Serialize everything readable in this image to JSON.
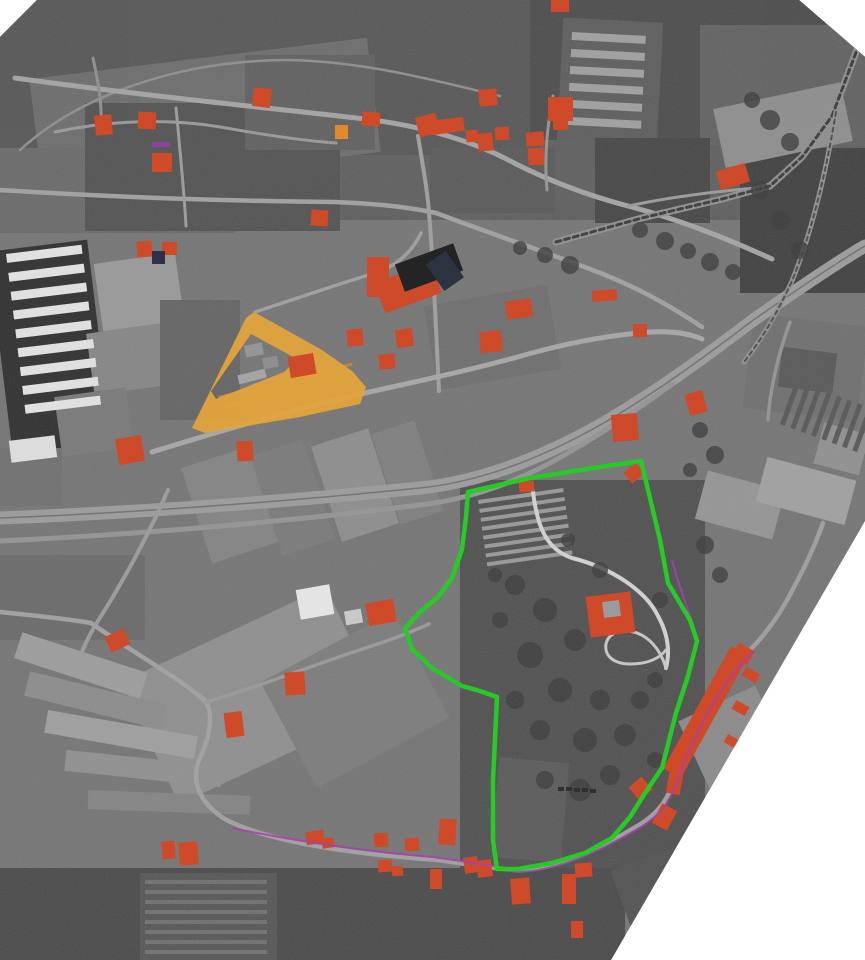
{
  "image": {
    "width": 865,
    "height": 960,
    "paper": "#ffffff"
  },
  "colors": {
    "photo_base": "#747474",
    "red_building": "#cf4a28",
    "dark_building": "#262626",
    "navy_building": "#2c3148",
    "purple_building": "#8a41a8",
    "orange_building": "#e08a28",
    "white_building": "#e4e4e4",
    "gray_building": "#969696",
    "yellow_complex": "#e2a43c",
    "yellow_ridge": "#bc852f",
    "green_boundary": "#26cb26",
    "magenta_line": "#a641ad",
    "tree": "#3a3a3a",
    "car": "#303030"
  },
  "photo_outline": [
    [
      0,
      37
    ],
    [
      37,
      0
    ],
    [
      799,
      0
    ],
    [
      865,
      57
    ],
    [
      865,
      521
    ],
    [
      611,
      960
    ],
    [
      0,
      960
    ]
  ],
  "terrain_patches": [
    [
      0,
      0,
      865,
      220,
      0,
      "#5e5e5e"
    ],
    [
      0,
      0,
      540,
      155,
      0,
      "#565656"
    ],
    [
      530,
      0,
      340,
      140,
      0,
      "#4b4b4b"
    ],
    [
      700,
      25,
      165,
      120,
      0,
      "#616161"
    ],
    [
      35,
      58,
      340,
      115,
      -7,
      "#6c6c6c"
    ],
    [
      0,
      148,
      235,
      85,
      0,
      "#696969"
    ],
    [
      85,
      103,
      255,
      128,
      0,
      "#515151"
    ],
    [
      245,
      55,
      130,
      95,
      0,
      "#5f5f5f"
    ],
    [
      560,
      20,
      100,
      125,
      3,
      "#5c5c5c"
    ],
    [
      430,
      148,
      125,
      65,
      0,
      "#585858"
    ],
    [
      595,
      138,
      115,
      85,
      0,
      "#454545"
    ],
    [
      740,
      148,
      130,
      145,
      0,
      "#3f3f3f"
    ],
    [
      718,
      95,
      130,
      60,
      -12,
      "#8d8d8d"
    ],
    [
      0,
      245,
      100,
      205,
      -7,
      "#2e2e2e"
    ],
    [
      98,
      258,
      82,
      68,
      -8,
      "#989898"
    ],
    [
      90,
      328,
      78,
      62,
      -8,
      "#858585"
    ],
    [
      58,
      392,
      72,
      60,
      -8,
      "#787878"
    ],
    [
      0,
      448,
      62,
      58,
      0,
      "#6f6f6f"
    ],
    [
      160,
      300,
      80,
      120,
      0,
      "#636363"
    ],
    [
      195,
      455,
      70,
      100,
      -18,
      "#828282"
    ],
    [
      265,
      445,
      55,
      105,
      -18,
      "#797979"
    ],
    [
      325,
      435,
      60,
      100,
      -18,
      "#8c8c8c"
    ],
    [
      385,
      425,
      45,
      95,
      -18,
      "#7e7e7e"
    ],
    [
      430,
      295,
      125,
      85,
      -10,
      "#6d6d6d"
    ],
    [
      460,
      480,
      245,
      400,
      0,
      "#4f4f4f"
    ],
    [
      495,
      760,
      70,
      100,
      5,
      "#595959"
    ],
    [
      690,
      700,
      85,
      75,
      -25,
      "#8a8a8a"
    ],
    [
      700,
      480,
      80,
      50,
      15,
      "#949494"
    ],
    [
      760,
      468,
      92,
      46,
      15,
      "#a0a0a0"
    ],
    [
      818,
      428,
      47,
      42,
      15,
      "#8f8f8f"
    ],
    [
      748,
      320,
      115,
      95,
      7,
      "#6e6e6e"
    ],
    [
      780,
      350,
      55,
      40,
      7,
      "#575757"
    ],
    [
      0,
      555,
      145,
      85,
      0,
      "#696969"
    ],
    [
      140,
      628,
      225,
      135,
      -25,
      "#8e8e8e"
    ],
    [
      280,
      640,
      150,
      120,
      -28,
      "#7b7b7b"
    ],
    [
      15,
      652,
      132,
      27,
      18,
      "#9c9c9c"
    ],
    [
      25,
      688,
      142,
      25,
      14,
      "#8b8b8b"
    ],
    [
      45,
      723,
      152,
      23,
      10,
      "#9e9e9e"
    ],
    [
      65,
      758,
      157,
      21,
      6,
      "#8f8f8f"
    ],
    [
      88,
      793,
      162,
      19,
      2,
      "#838383"
    ],
    [
      0,
      868,
      625,
      92,
      0,
      "#494949"
    ],
    [
      140,
      873,
      137,
      87,
      0,
      "#555555"
    ],
    [
      620,
      855,
      80,
      70,
      -20,
      "#525252"
    ]
  ],
  "stripe_blocks": [
    {
      "x": 6,
      "y": 254,
      "rows": 9,
      "pitch": 19,
      "len": 76,
      "h": 9,
      "rot": -7,
      "color": "#e3e3e3"
    },
    {
      "x": 572,
      "y": 32,
      "rows": 6,
      "pitch": 17,
      "len": 74,
      "h": 8,
      "rot": 3,
      "color": "#9f9f9f"
    },
    {
      "x": 780,
      "y": 424,
      "rows": 8,
      "pitch": 11,
      "len": 46,
      "h": 5,
      "rot": -70,
      "color": "#565656"
    },
    {
      "x": 478,
      "y": 500,
      "rows": 8,
      "pitch": 9,
      "len": 86,
      "h": 4,
      "rot": -8,
      "color": "#979797"
    },
    {
      "x": 145,
      "y": 880,
      "rows": 8,
      "pitch": 10,
      "len": 122,
      "h": 4,
      "rot": 0,
      "color": "#6f6f6f"
    },
    {
      "x": 218,
      "y": 396,
      "rows": 2,
      "pitch": 10,
      "len": 138,
      "h": 3,
      "rot": -14,
      "color": "#bc852f"
    }
  ],
  "roads": [
    {
      "d": "M20,150 C80,95 180,60 290,60 C370,62 440,82 500,96",
      "w": 2.5,
      "c": "#8d8d8d"
    },
    {
      "d": "M15,78 C130,94 260,107 365,119 C425,126 478,143 516,164 C552,182 590,196 628,206 C678,219 726,238 772,259",
      "w": 5,
      "c": "#a3a3a3"
    },
    {
      "d": "M628,206 C680,195 730,190 768,187",
      "w": 3,
      "c": "#9a9a9a"
    },
    {
      "d": "M0,190 C110,197 230,201 335,202 C385,204 412,208 436,213 C484,231 542,251 590,269 C640,288 672,307 702,327",
      "w": 4.5,
      "c": "#a0a0a0"
    },
    {
      "d": "M176,108 C180,150 184,190 186,226",
      "w": 3,
      "c": "#9a9a9a"
    },
    {
      "d": "M418,136 C424,172 428,196 429,213 C433,256 436,330 439,391",
      "w": 4,
      "c": "#9e9e9e"
    },
    {
      "d": "M255,312 C292,300 332,286 372,274 C396,267 412,252 421,233",
      "w": 3.5,
      "c": "#9e9e9e"
    },
    {
      "d": "M152,452 C230,428 312,404 392,387 C442,376 482,367 532,353 C572,342 612,335 650,332 C672,331 688,333 702,339",
      "w": 5,
      "c": "#a6a6a6"
    },
    {
      "d": "M0,518 C150,512 300,500 420,488 C480,482 542,458 602,424 C652,395 702,359 752,321 C802,286 836,263 865,246",
      "w": 13,
      "c": "#9b9b9b"
    },
    {
      "d": "M0,518 C150,512 300,500 420,488 C480,482 542,458 602,424 C652,395 702,359 752,321 C802,286 836,263 865,246",
      "w": 1.5,
      "c": "#6f6f6f"
    },
    {
      "d": "M0,541 C150,534 300,520 420,505 C472,499 522,480 566,454 C602,433 640,408 672,384",
      "w": 5,
      "c": "#939393"
    },
    {
      "d": "M556,242 L642,218 L722,199 L770,186 L802,157 L832,116 L858,47",
      "w": 7,
      "c": "#8f8f8f"
    },
    {
      "d": "M556,242 L642,218 L722,199 L770,186 L802,157 L832,116 L858,47",
      "w": 3,
      "c": "#3a3a3a",
      "dash": "5,4"
    },
    {
      "d": "M836,112 C826,172 812,232 792,281 C774,320 758,344 744,362",
      "w": 5,
      "c": "#8f8f8f"
    },
    {
      "d": "M836,112 C826,172 812,232 792,281 C774,320 758,344 744,362",
      "w": 2,
      "c": "#4a4a4a",
      "dash": "4,4"
    },
    {
      "d": "M168,490 C150,532 122,584 96,624 C90,634 85,644 81,654",
      "w": 4,
      "c": "#9a9a9a"
    },
    {
      "d": "M0,612 C30,615 62,618 91,623",
      "w": 4.5,
      "c": "#a0a0a0"
    },
    {
      "d": "M91,623 C132,652 186,682 206,702 C214,716 209,740 199,760 C191,782 199,801 223,818 C259,838 320,848 372,854 C406,858 426,859 438,860",
      "w": 4.5,
      "c": "#a0a0a0"
    },
    {
      "d": "M438,860 C473,865 501,870 523,870 C561,868 601,848 639,825 C659,813 667,799 673,784 C689,734 719,681 749,651 C766,634 781,613 793,589 C807,563 816,543 823,523",
      "w": 4.5,
      "c": "#9e9e9e"
    },
    {
      "d": "M206,702 C256,688 321,662 366,648 C396,638 416,630 429,624",
      "w": 3.5,
      "c": "#989898"
    },
    {
      "d": "M533,492 C537,524 545,549 572,558 C612,568 646,591 658,616 C668,634 670,652 666,668",
      "w": 4,
      "c": "#d2d2d2"
    },
    {
      "d": "M666,668 C660,648 648,636 634,632 C620,628 608,634 606,644 C604,656 614,664 630,664 C646,664 658,660 666,650",
      "w": 3,
      "c": "#c8c8c8"
    },
    {
      "d": "M768,420 C770,390 778,355 790,322",
      "w": 3.5,
      "c": "#929292"
    },
    {
      "d": "M55,132 C112,120 172,118 226,128 C271,136 306,141 336,143",
      "w": 3,
      "c": "#989898"
    },
    {
      "d": "M93,58 C100,90 103,112 100,133",
      "w": 3,
      "c": "#8f8f8f"
    },
    {
      "d": "M553,96 C547,128 544,158 547,190",
      "w": 3,
      "c": "#949494"
    }
  ],
  "trees": [
    [
      515,
      585,
      10
    ],
    [
      545,
      610,
      12
    ],
    [
      575,
      640,
      11
    ],
    [
      530,
      655,
      13
    ],
    [
      560,
      690,
      12
    ],
    [
      600,
      700,
      10
    ],
    [
      625,
      735,
      11
    ],
    [
      585,
      740,
      12
    ],
    [
      540,
      730,
      10
    ],
    [
      515,
      700,
      9
    ],
    [
      610,
      775,
      10
    ],
    [
      580,
      790,
      11
    ],
    [
      545,
      780,
      9
    ],
    [
      640,
      700,
      9
    ],
    [
      655,
      680,
      8
    ],
    [
      500,
      620,
      8
    ],
    [
      495,
      575,
      7
    ],
    [
      655,
      760,
      8
    ],
    [
      640,
      230,
      8
    ],
    [
      665,
      241,
      9
    ],
    [
      688,
      251,
      8
    ],
    [
      710,
      262,
      9
    ],
    [
      733,
      272,
      8
    ],
    [
      700,
      430,
      8
    ],
    [
      715,
      455,
      9
    ],
    [
      690,
      470,
      7
    ],
    [
      770,
      120,
      10
    ],
    [
      790,
      142,
      9
    ],
    [
      752,
      100,
      8
    ],
    [
      705,
      545,
      9
    ],
    [
      720,
      575,
      8
    ],
    [
      600,
      570,
      8
    ],
    [
      568,
      540,
      7
    ],
    [
      660,
      600,
      8
    ],
    [
      760,
      190,
      9
    ],
    [
      780,
      220,
      10
    ],
    [
      800,
      250,
      9
    ],
    [
      545,
      255,
      8
    ],
    [
      570,
      265,
      9
    ],
    [
      520,
      248,
      7
    ]
  ],
  "buildings": {
    "red": [
      [
        95,
        115,
        17,
        20,
        -5
      ],
      [
        138,
        112,
        18,
        17,
        3
      ],
      [
        152,
        153,
        20,
        19,
        0
      ],
      [
        253,
        88,
        18,
        19,
        7
      ],
      [
        362,
        112,
        18,
        14,
        3
      ],
      [
        417,
        115,
        21,
        20,
        -15
      ],
      [
        479,
        89,
        18,
        17,
        -5
      ],
      [
        548,
        97,
        25,
        24,
        0
      ],
      [
        551,
        0,
        18,
        12,
        0
      ],
      [
        553,
        117,
        15,
        13,
        0
      ],
      [
        430,
        119,
        34,
        14,
        -8
      ],
      [
        466,
        130,
        12,
        12,
        -5
      ],
      [
        478,
        133,
        15,
        18,
        -5
      ],
      [
        495,
        127,
        14,
        13,
        -3
      ],
      [
        526,
        132,
        18,
        14,
        -5
      ],
      [
        528,
        148,
        16,
        17,
        -3
      ],
      [
        718,
        167,
        30,
        19,
        -17
      ],
      [
        311,
        210,
        17,
        16,
        4
      ],
      [
        137,
        241,
        15,
        16,
        -5
      ],
      [
        162,
        242,
        15,
        13,
        0
      ],
      [
        367,
        257,
        22,
        40,
        0
      ],
      [
        378,
        272,
        60,
        32,
        -20
      ],
      [
        592,
        290,
        25,
        11,
        -4
      ],
      [
        506,
        300,
        26,
        18,
        -8
      ],
      [
        480,
        331,
        22,
        21,
        -5
      ],
      [
        633,
        324,
        14,
        13,
        0
      ],
      [
        347,
        329,
        16,
        17,
        -5
      ],
      [
        396,
        329,
        17,
        18,
        -8
      ],
      [
        379,
        354,
        16,
        15,
        -5
      ],
      [
        289,
        355,
        26,
        21,
        -10
      ],
      [
        117,
        437,
        26,
        26,
        -10
      ],
      [
        237,
        441,
        16,
        20,
        -4
      ],
      [
        687,
        392,
        18,
        22,
        -15
      ],
      [
        612,
        414,
        26,
        27,
        -5
      ],
      [
        519,
        481,
        15,
        11,
        -5
      ],
      [
        626,
        466,
        16,
        14,
        -40
      ],
      [
        588,
        594,
        45,
        41,
        -7
      ],
      [
        367,
        601,
        28,
        23,
        -10
      ],
      [
        107,
        632,
        21,
        17,
        -25
      ],
      [
        285,
        672,
        20,
        23,
        -4
      ],
      [
        225,
        712,
        18,
        25,
        -7
      ],
      [
        696,
        642,
        20,
        140,
        29
      ],
      [
        734,
        646,
        18,
        16,
        29
      ],
      [
        743,
        670,
        16,
        10,
        29
      ],
      [
        733,
        703,
        15,
        10,
        29
      ],
      [
        725,
        737,
        14,
        9,
        29
      ],
      [
        668,
        768,
        14,
        26,
        10
      ],
      [
        632,
        780,
        17,
        17,
        -40
      ],
      [
        656,
        806,
        17,
        22,
        28
      ],
      [
        439,
        819,
        17,
        26,
        4
      ],
      [
        464,
        857,
        14,
        16,
        -8
      ],
      [
        477,
        860,
        15,
        17,
        -8
      ],
      [
        511,
        878,
        19,
        26,
        -4
      ],
      [
        562,
        874,
        14,
        30,
        0
      ],
      [
        575,
        863,
        17,
        14,
        -4
      ],
      [
        571,
        921,
        12,
        17,
        0
      ],
      [
        430,
        869,
        12,
        20,
        0
      ],
      [
        162,
        841,
        13,
        18,
        -4
      ],
      [
        179,
        842,
        19,
        23,
        -4
      ],
      [
        306,
        831,
        18,
        13,
        -8
      ],
      [
        322,
        838,
        12,
        10,
        -8
      ],
      [
        374,
        833,
        14,
        14,
        -4
      ],
      [
        405,
        838,
        14,
        13,
        -4
      ],
      [
        378,
        860,
        14,
        12,
        -4
      ],
      [
        392,
        866,
        11,
        10,
        -4
      ]
    ],
    "dark": [
      [
        398,
        253,
        62,
        29,
        -20,
        "#242424"
      ],
      [
        433,
        255,
        24,
        32,
        -35,
        "#2b3440"
      ],
      [
        152,
        251,
        13,
        13,
        0,
        "#2c3148"
      ]
    ],
    "purple": [
      [
        152,
        142,
        18,
        5,
        0,
        "#8a41a8"
      ]
    ],
    "orange": [
      [
        335,
        125,
        13,
        14,
        0,
        "#e08a28"
      ]
    ],
    "white": [
      [
        298,
        587,
        34,
        30,
        -10,
        "#e4e4e4"
      ],
      [
        345,
        610,
        17,
        14,
        -10,
        "#c9c9c9"
      ],
      [
        10,
        438,
        46,
        22,
        -7,
        "#dcdcdc"
      ]
    ],
    "gray": [
      [
        603,
        601,
        17,
        16,
        -7,
        "#9b9b9b"
      ],
      [
        245,
        344,
        18,
        12,
        -10,
        "#969696"
      ],
      [
        263,
        357,
        15,
        11,
        -10,
        "#8f8f8f"
      ],
      [
        238,
        372,
        28,
        9,
        -14,
        "#a5a5a5"
      ]
    ]
  },
  "cars": [
    [
      558,
      787,
      6,
      4
    ],
    [
      566,
      787,
      6,
      4
    ],
    [
      574,
      788,
      6,
      4
    ],
    [
      582,
      788,
      6,
      4
    ],
    [
      590,
      789,
      6,
      4
    ]
  ],
  "yellow_complex": {
    "outer": [
      [
        254,
        312
      ],
      [
        322,
        350
      ],
      [
        352,
        371
      ],
      [
        366,
        387
      ],
      [
        360,
        404
      ],
      [
        300,
        417
      ],
      [
        205,
        433
      ],
      [
        192,
        428
      ],
      [
        246,
        318
      ]
    ],
    "hole": [
      [
        251,
        334
      ],
      [
        297,
        359
      ],
      [
        284,
        372
      ],
      [
        216,
        399
      ],
      [
        211,
        391
      ]
    ]
  },
  "green_boundary": {
    "stroke_width": 4.5,
    "points": [
      [
        468,
        492
      ],
      [
        530,
        478
      ],
      [
        600,
        467
      ],
      [
        641,
        461
      ],
      [
        649,
        494
      ],
      [
        660,
        540
      ],
      [
        668,
        583
      ],
      [
        690,
        620
      ],
      [
        697,
        641
      ],
      [
        688,
        676
      ],
      [
        676,
        713
      ],
      [
        662,
        768
      ],
      [
        647,
        790
      ],
      [
        630,
        817
      ],
      [
        612,
        838
      ],
      [
        585,
        853
      ],
      [
        552,
        863
      ],
      [
        518,
        869
      ],
      [
        497,
        869
      ],
      [
        493,
        840
      ],
      [
        493,
        780
      ],
      [
        496,
        718
      ],
      [
        497,
        697
      ],
      [
        480,
        691
      ],
      [
        462,
        686
      ],
      [
        432,
        668
      ],
      [
        412,
        649
      ],
      [
        405,
        628
      ],
      [
        420,
        612
      ],
      [
        438,
        597
      ],
      [
        452,
        578
      ],
      [
        462,
        549
      ],
      [
        466,
        517
      ]
    ]
  },
  "magenta_lines": [
    {
      "d": "M232,828 C300,842 370,852 432,857 C462,861 480,864 494,866 C500,868 510,872 520,872 C560,870 602,850 641,827 C662,814 670,800 676,785 C692,735 722,682 752,652",
      "w": 2
    },
    {
      "d": "M672,560 C680,590 690,615 698,640",
      "w": 2
    }
  ]
}
